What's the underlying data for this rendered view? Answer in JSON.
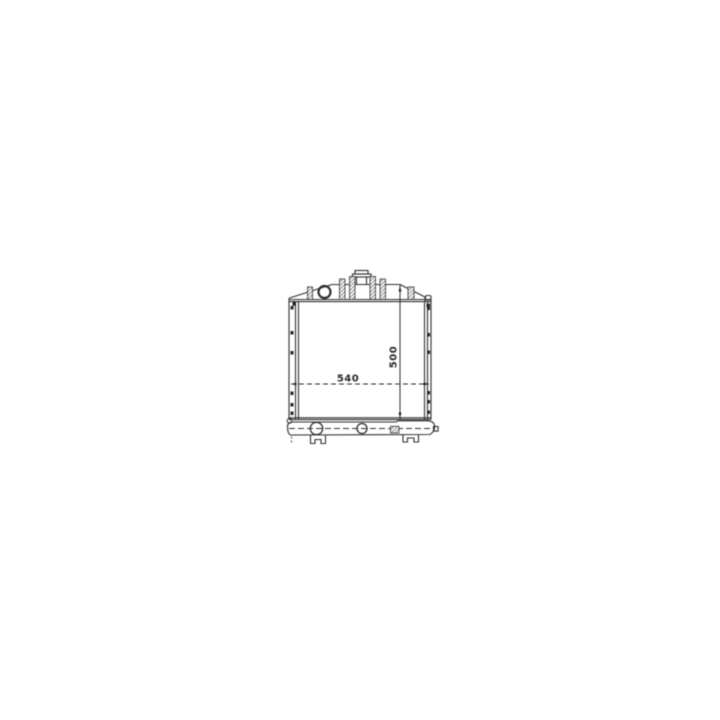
{
  "canvas": {
    "background": "#ffffff",
    "line_color": "#2f2f2f"
  },
  "dimensions": {
    "width_label": "540",
    "height_label": "500"
  }
}
